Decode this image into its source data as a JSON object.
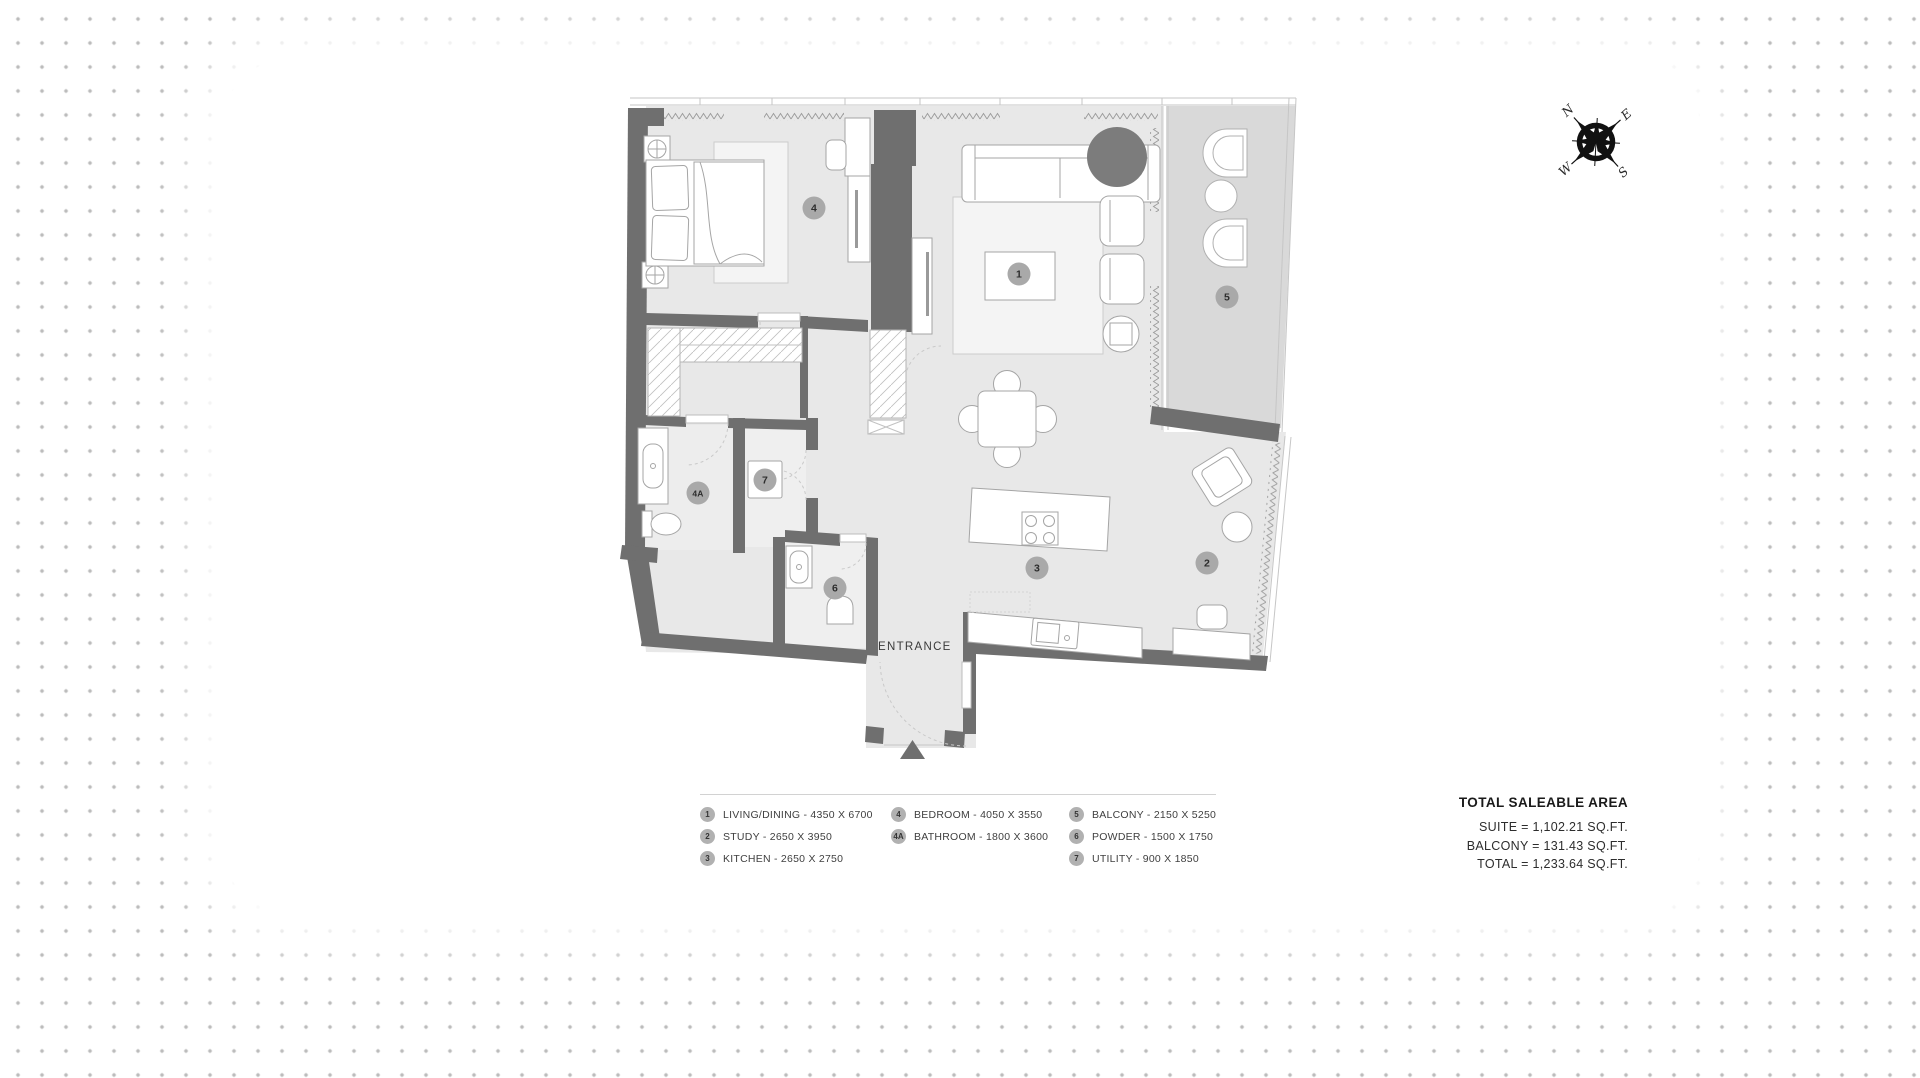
{
  "plan": {
    "entrance_label": "ENTRANCE",
    "badges": [
      "1",
      "2",
      "3",
      "4",
      "4A",
      "5",
      "6",
      "7"
    ]
  },
  "compass": {
    "north": "N",
    "east": "E",
    "south": "S",
    "west": "W"
  },
  "legend": {
    "columns": [
      {
        "items": [
          {
            "num": "1",
            "label": "LIVING/DINING - 4350 X 6700"
          },
          {
            "num": "2",
            "label": "STUDY - 2650 X 3950"
          },
          {
            "num": "3",
            "label": "KITCHEN - 2650 X 2750"
          }
        ]
      },
      {
        "items": [
          {
            "num": "4",
            "label": "BEDROOM - 4050 X 3550"
          },
          {
            "num": "4A",
            "label": "BATHROOM - 1800 X 3600"
          }
        ]
      },
      {
        "items": [
          {
            "num": "5",
            "label": "BALCONY - 2150 X 5250"
          },
          {
            "num": "6",
            "label": "POWDER - 1500 X 1750"
          },
          {
            "num": "7",
            "label": "UTILITY - 900 X 1850"
          }
        ]
      }
    ]
  },
  "totals": {
    "title": "TOTAL SALEABLE AREA",
    "lines": [
      "SUITE = 1,102.21 SQ.FT.",
      "BALCONY = 131.43 SQ.FT.",
      "TOTAL = 1,233.64 SQ.FT."
    ]
  }
}
